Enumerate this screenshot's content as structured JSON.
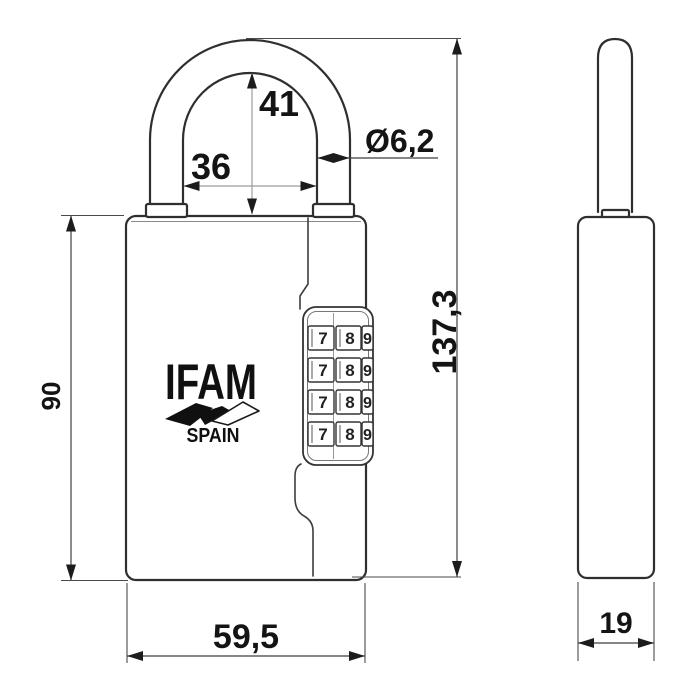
{
  "drawing": {
    "brand": "IFAM",
    "country": "SPAIN",
    "dimensions": {
      "shackle_inner_height": "41",
      "shackle_inner_width": "36",
      "shackle_diameter": "Ø6,2",
      "total_height": "137,3",
      "body_height": "90",
      "body_width": "59,5",
      "body_depth": "19"
    },
    "wheels": {
      "rows": [
        [
          "7",
          "8",
          "9"
        ],
        [
          "7",
          "8",
          "9"
        ],
        [
          "7",
          "8",
          "9"
        ],
        [
          "7",
          "8",
          "9"
        ]
      ]
    },
    "colors": {
      "line": "#2f2f2f",
      "dimension_line": "#3f3f3f",
      "light_dimension_line": "#9c9c9c",
      "background": "#ffffff"
    }
  }
}
